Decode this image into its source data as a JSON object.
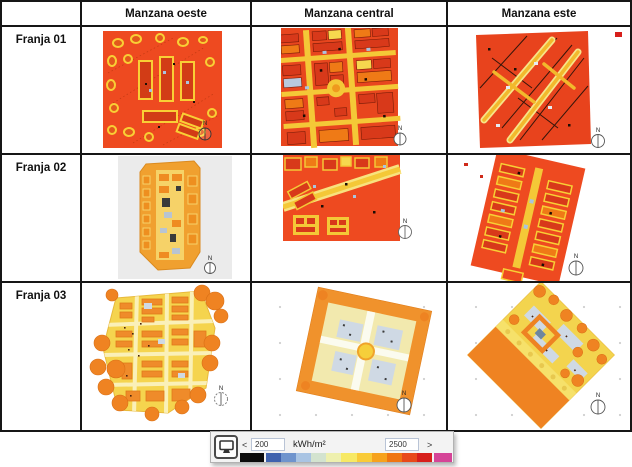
{
  "header": {
    "col0": "",
    "col1": "Manzana oeste",
    "col2": "Manzana central",
    "col3": "Manzana este"
  },
  "rows": [
    {
      "label": "Franja 01"
    },
    {
      "label": "Franja 02"
    },
    {
      "label": "Franja 03"
    }
  ],
  "north_marker": "N",
  "legend": {
    "min_value": "200",
    "max_value": "2500",
    "unit": "kWh/m²",
    "decrease": "<",
    "increase": ">",
    "swatch_black": "#0b0b0b",
    "swatch_overflow": "#d54497",
    "ramp_colors": [
      "#3f62ae",
      "#6f94cd",
      "#a9c4e3",
      "#d3e3cf",
      "#eef0ae",
      "#f7e964",
      "#f9cb38",
      "#f6a21d",
      "#ef7512",
      "#e8491a",
      "#d71f1b"
    ]
  },
  "palette": {
    "map_red_orange": "#ee4a20",
    "map_dark_red": "#d8391a",
    "map_orange": "#ef8b2a",
    "map_yellow_street": "#f4c837",
    "map_pale_yellow": "#f5d44e",
    "map_pale_blue": "#cfd9e4",
    "map_gray_bg": "#ebebeb",
    "table_border": "#161616"
  }
}
